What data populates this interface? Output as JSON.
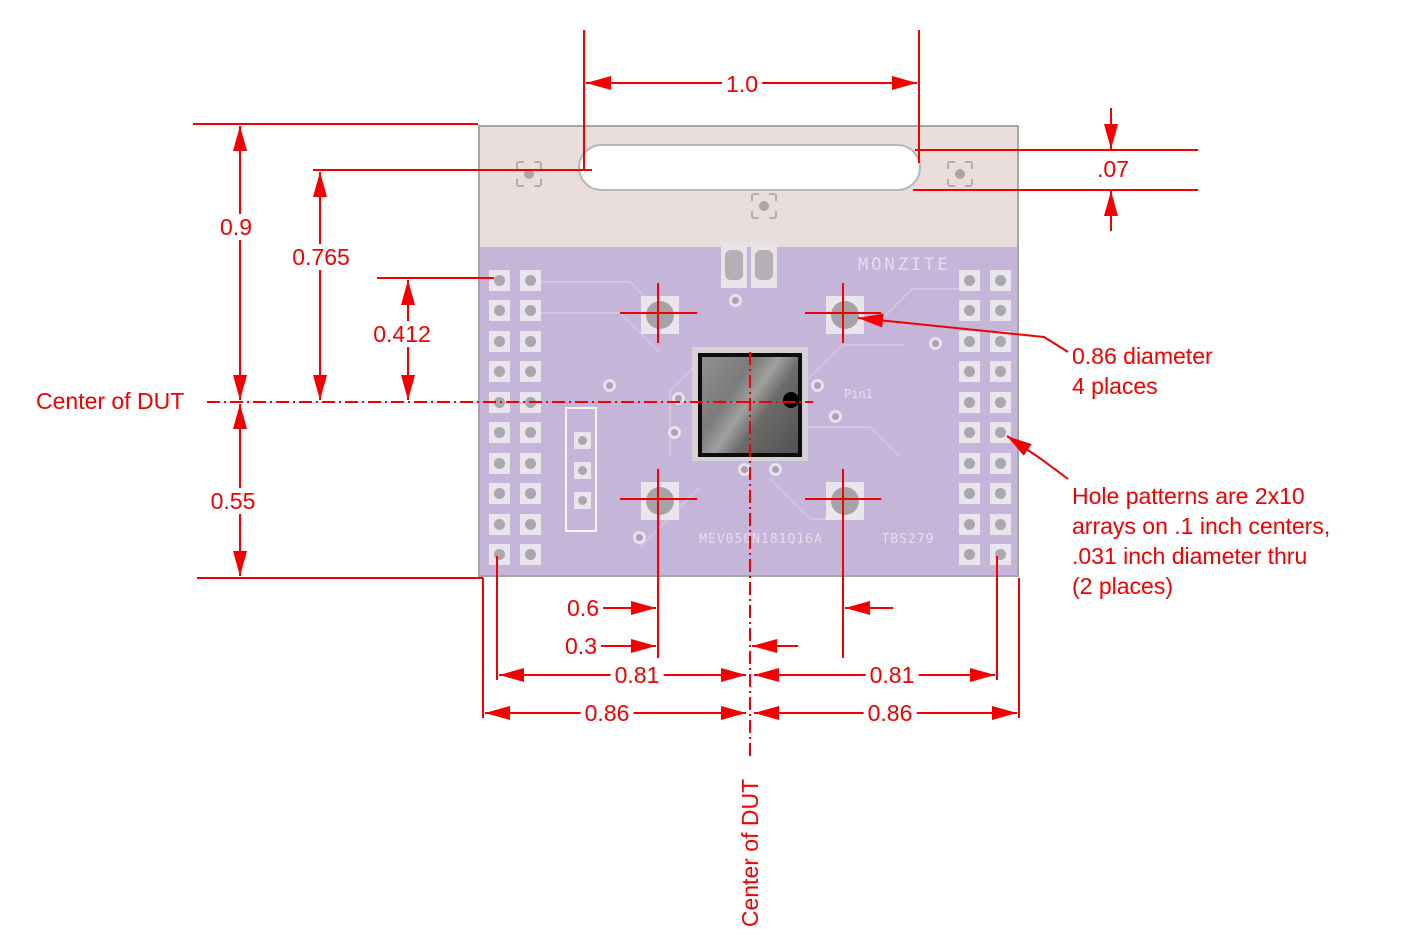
{
  "dimensions": {
    "slot_length": "1.0",
    "slot_width": ".07",
    "top_to_center": "0.9",
    "slot_to_center": "0.765",
    "hole_row_to_center": "0.412",
    "center_to_bottom_edge": "0.55",
    "mount_hole_spacing": "0.6",
    "center_to_mount_hole": "0.3",
    "center_to_hole_col_left": "0.81",
    "center_to_hole_col_right": "0.81",
    "center_to_edge_left": "0.86",
    "center_to_edge_right": "0.86"
  },
  "centerlines": {
    "horizontal_label": "Center of DUT",
    "vertical_label": "Center of DUT"
  },
  "notes": {
    "mount_hole_note": {
      "line1": "0.86 diameter",
      "line2": "4 places"
    },
    "hole_pattern_note": {
      "line1": "Hole patterns are 2x10",
      "line2": "arrays on .1 inch centers,",
      "line3": ".031 inch diameter thru",
      "line4": "(2 places)"
    }
  },
  "board": {
    "silkscreen": {
      "brand": "MONZITE",
      "part_number": "MEV050N181Q16A",
      "board_id": "TBS279",
      "pin1_label": "Pin1"
    },
    "hole_array": {
      "cols": 2,
      "rows": 10
    }
  },
  "colors": {
    "dimension_red": "#f40000",
    "board_purple": "#c4b5d9",
    "board_tan": "#e9dedb",
    "pad_light": "#eae4ec",
    "hole_gray": "#a8a8ae",
    "chip_border": "#0d0d0d"
  }
}
